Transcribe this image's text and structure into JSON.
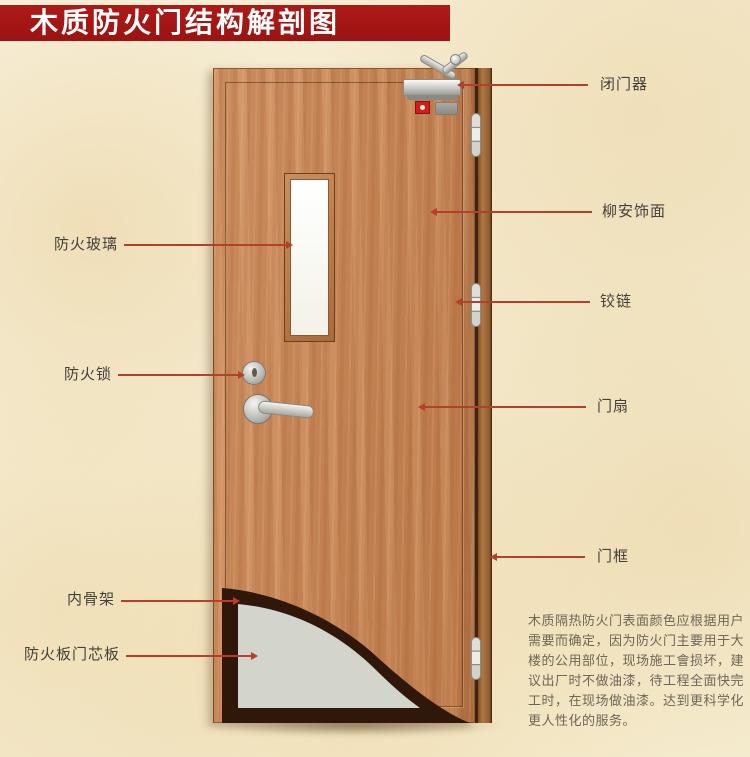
{
  "title": "木质防火门结构解剖图",
  "labels": {
    "left": [
      {
        "text": "防火玻璃"
      },
      {
        "text": "防火锁"
      },
      {
        "text": "内骨架"
      },
      {
        "text": "防火板门芯板"
      }
    ],
    "right": [
      {
        "text": "闭门器"
      },
      {
        "text": "柳安饰面"
      },
      {
        "text": "铰链"
      },
      {
        "text": "门扇"
      },
      {
        "text": "门框"
      }
    ]
  },
  "description": "木质隔热防火门表面颜色应根据用户需要而确定，因为防火门主要用于大楼的公用部位，现场施工會损坏，建议出厂时不做油漆，待工程全面快完工时，在现场做油漆。达到更科学化更人性化的服务。",
  "colors": {
    "banner": "#a31616",
    "arrow": "#b4402c",
    "door_wood": "#c8875a",
    "core_panel": "#d3d4cb",
    "inner_skeleton": "#2f170a"
  }
}
